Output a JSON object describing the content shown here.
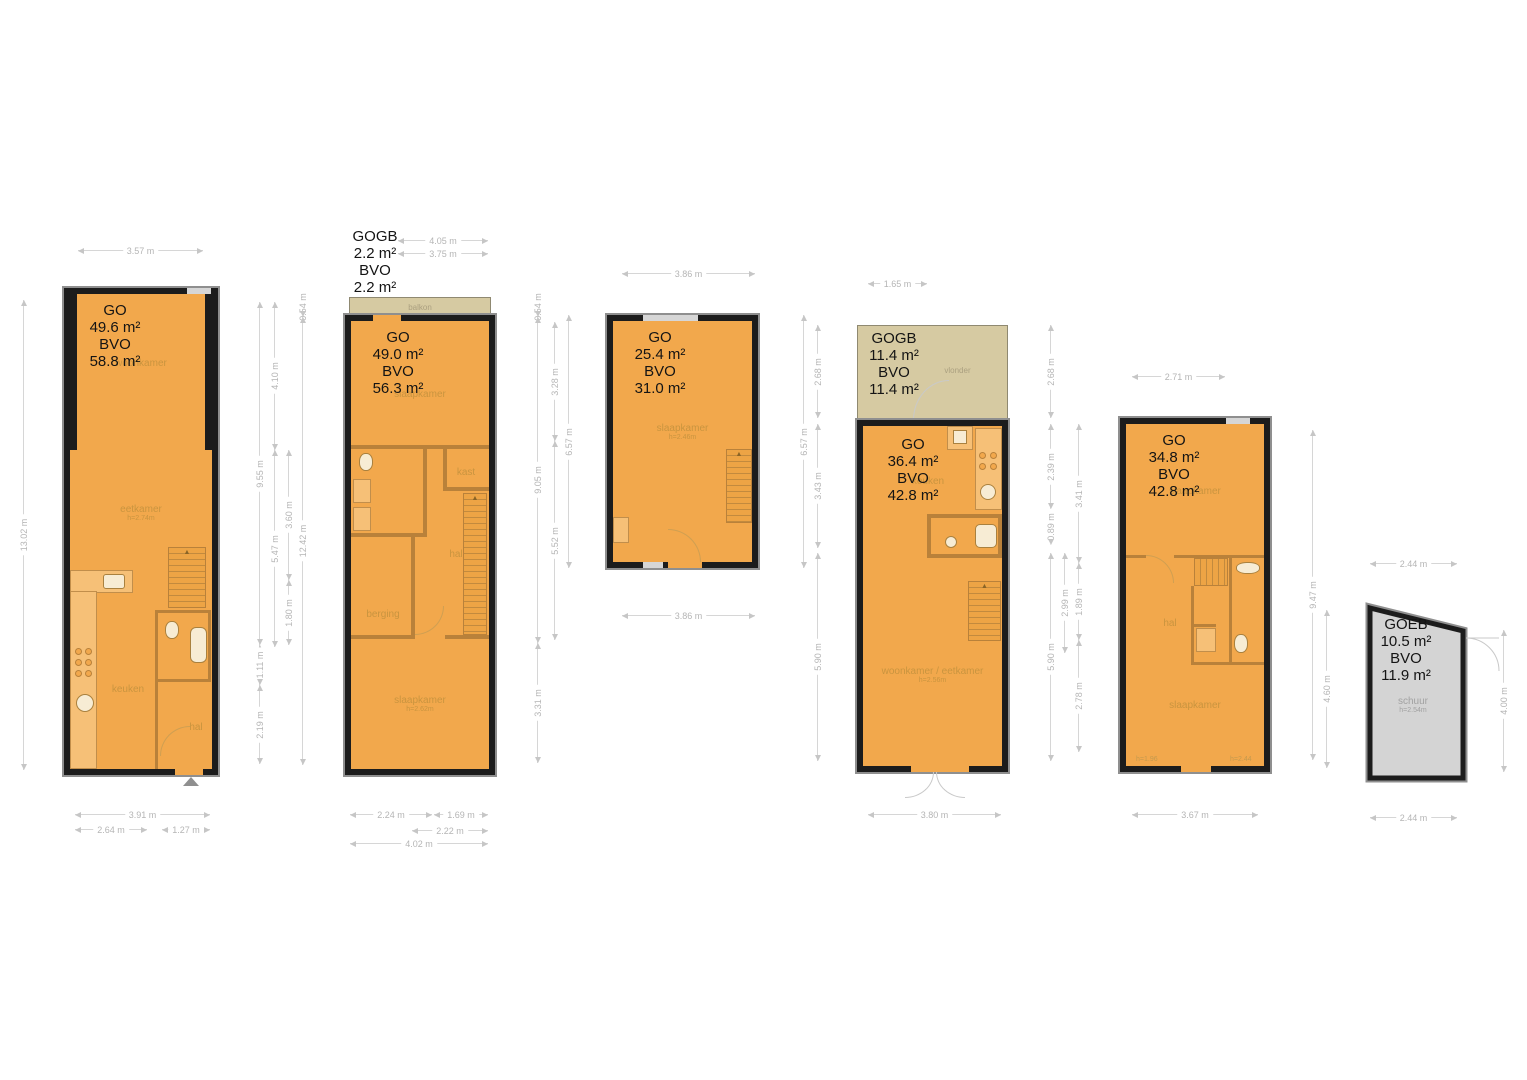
{
  "colors": {
    "floor": "#f2a84c",
    "wall": "#1c1c1c",
    "outdoor": "#d6caa2",
    "shed": "#d4d4d4",
    "dim_line": "#d6d6d6",
    "dim_text": "#b5b5b5",
    "room_text": "#c2913d"
  },
  "plans": [
    {
      "key": "level-1",
      "area": {
        "l1": "GO",
        "l2": "49.6 m²",
        "l3": "BVO",
        "l4": "58.8 m²"
      },
      "rooms": {
        "woonkamer": "woonkamer",
        "eetkamer": "eetkamer",
        "eetkamer_h": "h=2.74m",
        "keuken": "keuken",
        "hal": "hal"
      }
    },
    {
      "key": "level-2",
      "outdoor": "balkon",
      "gogb": {
        "l1": "GOGB",
        "l2": "2.2 m²",
        "l3": "BVO",
        "l4": "2.2 m²"
      },
      "area": {
        "l1": "GO",
        "l2": "49.0 m²",
        "l3": "BVO",
        "l4": "56.3 m²"
      },
      "rooms": {
        "slaapkamer_top": "slaapkamer",
        "kast": "kast",
        "hal": "hal",
        "berging": "berging",
        "slaapkamer": "slaapkamer",
        "slaapkamer_h": "h=2.62m"
      }
    },
    {
      "key": "level-3",
      "area": {
        "l1": "GO",
        "l2": "25.4 m²",
        "l3": "BVO",
        "l4": "31.0 m²"
      },
      "rooms": {
        "slaapkamer": "slaapkamer",
        "slaapkamer_h": "h=2.46m"
      }
    },
    {
      "key": "level-4",
      "outdoor": "vlonder",
      "gogb": {
        "l1": "GOGB",
        "l2": "11.4 m²",
        "l3": "BVO",
        "l4": "11.4 m²"
      },
      "area": {
        "l1": "GO",
        "l2": "36.4 m²",
        "l3": "BVO",
        "l4": "42.8 m²"
      },
      "rooms": {
        "keuken": "keuken",
        "woonkamer": "woonkamer / eetkamer",
        "woonkamer_h": "h=2.56m"
      }
    },
    {
      "key": "level-5",
      "area": {
        "l1": "GO",
        "l2": "34.8 m²",
        "l3": "BVO",
        "l4": "42.8 m²"
      },
      "rooms": {
        "slaapkamer_top": "slaapkamer",
        "hal": "hal",
        "slaapkamer": "slaapkamer",
        "h_left": "h=1.96",
        "h_right": "h=2.44"
      }
    },
    {
      "key": "schuur",
      "area": {
        "l1": "GOEB",
        "l2": "10.5 m²",
        "l3": "BVO",
        "l4": "11.9 m²"
      },
      "rooms": {
        "schuur": "schuur",
        "schuur_h": "h=2.54m"
      }
    }
  ],
  "dimensions": [
    {
      "t": "3.57 m",
      "o": "h",
      "x": 78,
      "y": 250,
      "l": 125
    },
    {
      "t": "3.91 m",
      "o": "h",
      "x": 75,
      "y": 814,
      "l": 135
    },
    {
      "t": "2.64 m",
      "o": "h",
      "x": 75,
      "y": 829,
      "l": 72
    },
    {
      "t": "1.27 m",
      "o": "h",
      "x": 162,
      "y": 829,
      "l": 48
    },
    {
      "t": "4.05 m",
      "o": "h",
      "x": 398,
      "y": 240,
      "l": 90
    },
    {
      "t": "3.75 m",
      "o": "h",
      "x": 398,
      "y": 253,
      "l": 90
    },
    {
      "t": "2.24 m",
      "o": "h",
      "x": 350,
      "y": 814,
      "l": 82
    },
    {
      "t": "1.69 m",
      "o": "h",
      "x": 434,
      "y": 814,
      "l": 54
    },
    {
      "t": "2.22 m",
      "o": "h",
      "x": 412,
      "y": 830,
      "l": 76
    },
    {
      "t": "4.02 m",
      "o": "h",
      "x": 350,
      "y": 843,
      "l": 138
    },
    {
      "t": "3.86 m",
      "o": "h",
      "x": 622,
      "y": 273,
      "l": 133
    },
    {
      "t": "3.86 m",
      "o": "h",
      "x": 622,
      "y": 615,
      "l": 133
    },
    {
      "t": "1.65 m",
      "o": "h",
      "x": 868,
      "y": 283,
      "l": 59
    },
    {
      "t": "3.80 m",
      "o": "h",
      "x": 868,
      "y": 814,
      "l": 133
    },
    {
      "t": "2.71 m",
      "o": "h",
      "x": 1132,
      "y": 376,
      "l": 93
    },
    {
      "t": "3.67 m",
      "o": "h",
      "x": 1132,
      "y": 814,
      "l": 126
    },
    {
      "t": "2.44 m",
      "o": "h",
      "x": 1370,
      "y": 563,
      "l": 87
    },
    {
      "t": "2.44 m",
      "o": "h",
      "x": 1370,
      "y": 817,
      "l": 87
    },
    {
      "t": "13.02 m",
      "o": "v",
      "x": 23,
      "y": 300,
      "l": 470
    },
    {
      "t": "9.55 m",
      "o": "v",
      "x": 259,
      "y": 302,
      "l": 343
    },
    {
      "t": "1.11 m",
      "o": "v",
      "x": 259,
      "y": 645,
      "l": 40
    },
    {
      "t": "2.19 m",
      "o": "v",
      "x": 259,
      "y": 685,
      "l": 79
    },
    {
      "t": "4.10 m",
      "o": "v",
      "x": 274,
      "y": 302,
      "l": 148
    },
    {
      "t": "5.47 m",
      "o": "v",
      "x": 274,
      "y": 450,
      "l": 197
    },
    {
      "t": "3.60 m",
      "o": "v",
      "x": 288,
      "y": 450,
      "l": 130
    },
    {
      "t": "1.80 m",
      "o": "v",
      "x": 288,
      "y": 580,
      "l": 65
    },
    {
      "t": "0.54 m",
      "o": "v",
      "x": 302,
      "y": 297,
      "l": 20
    },
    {
      "t": "12.42 m",
      "o": "v",
      "x": 302,
      "y": 317,
      "l": 448
    },
    {
      "t": "0.54 m",
      "o": "v",
      "x": 537,
      "y": 297,
      "l": 20
    },
    {
      "t": "9.05 m",
      "o": "v",
      "x": 537,
      "y": 317,
      "l": 326
    },
    {
      "t": "3.31 m",
      "o": "v",
      "x": 537,
      "y": 643,
      "l": 120
    },
    {
      "t": "3.28 m",
      "o": "v",
      "x": 554,
      "y": 322,
      "l": 119
    },
    {
      "t": "5.52 m",
      "o": "v",
      "x": 554,
      "y": 441,
      "l": 199
    },
    {
      "t": "6.57 m",
      "o": "v",
      "x": 568,
      "y": 315,
      "l": 253
    },
    {
      "t": "6.57 m",
      "o": "v",
      "x": 803,
      "y": 315,
      "l": 253
    },
    {
      "t": "2.68 m",
      "o": "v",
      "x": 817,
      "y": 325,
      "l": 93
    },
    {
      "t": "3.43 m",
      "o": "v",
      "x": 817,
      "y": 424,
      "l": 124
    },
    {
      "t": "5.90 m",
      "o": "v",
      "x": 817,
      "y": 553,
      "l": 208
    },
    {
      "t": "2.68 m",
      "o": "v",
      "x": 1050,
      "y": 325,
      "l": 93
    },
    {
      "t": "2.39 m",
      "o": "v",
      "x": 1050,
      "y": 424,
      "l": 85
    },
    {
      "t": "0.89 m",
      "o": "v",
      "x": 1050,
      "y": 509,
      "l": 36
    },
    {
      "t": "5.90 m",
      "o": "v",
      "x": 1050,
      "y": 553,
      "l": 208
    },
    {
      "t": "2.99 m",
      "o": "v",
      "x": 1064,
      "y": 553,
      "l": 100
    },
    {
      "t": "3.41 m",
      "o": "v",
      "x": 1078,
      "y": 424,
      "l": 139
    },
    {
      "t": "1.89 m",
      "o": "v",
      "x": 1078,
      "y": 563,
      "l": 77
    },
    {
      "t": "2.78 m",
      "o": "v",
      "x": 1078,
      "y": 640,
      "l": 112
    },
    {
      "t": "9.47 m",
      "o": "v",
      "x": 1312,
      "y": 430,
      "l": 330
    },
    {
      "t": "4.60 m",
      "o": "v",
      "x": 1326,
      "y": 610,
      "l": 158
    },
    {
      "t": "4.00 m",
      "o": "v",
      "x": 1503,
      "y": 630,
      "l": 142
    }
  ]
}
